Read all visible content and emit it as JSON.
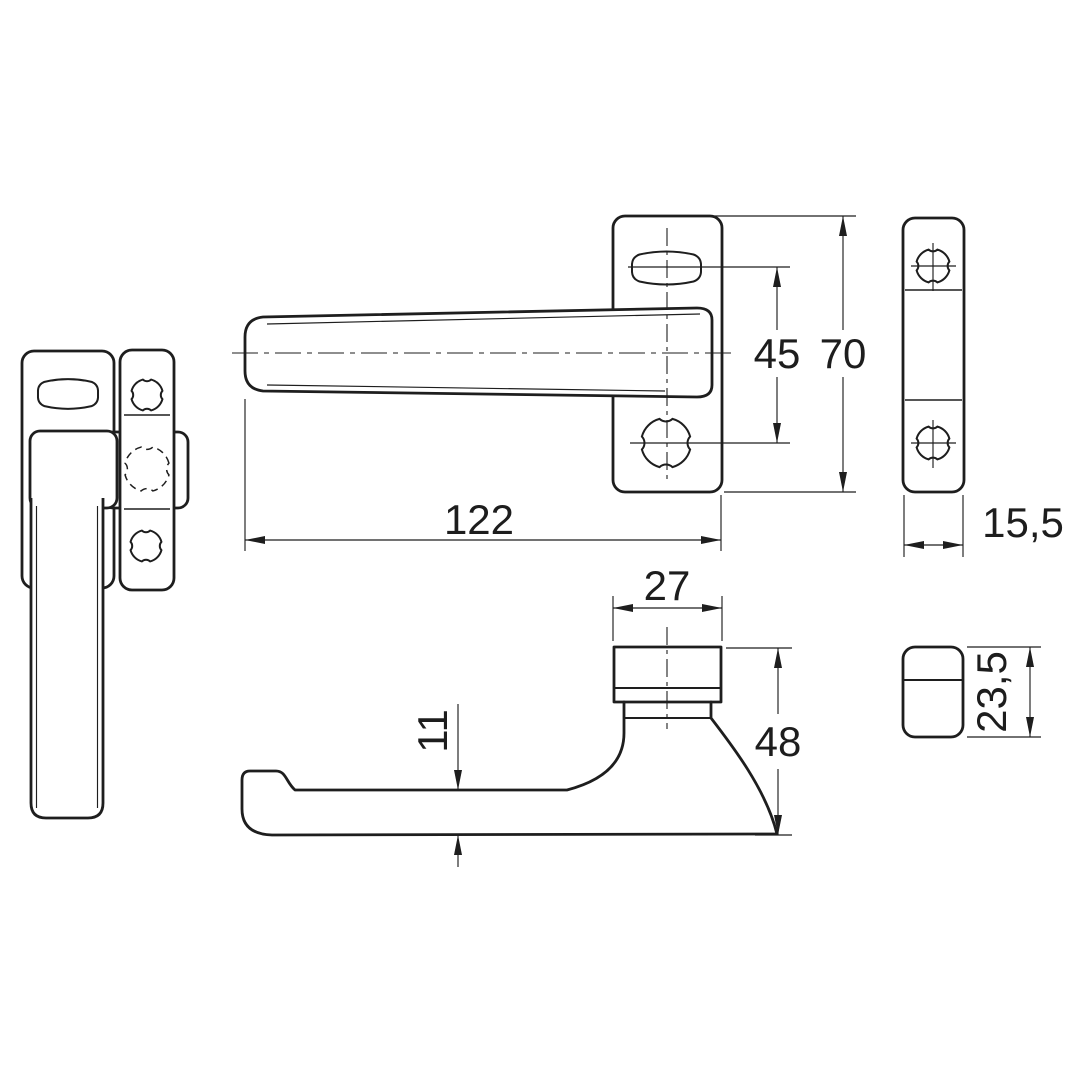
{
  "colors": {
    "line": "#1e1e1e",
    "text": "#1d1d1d",
    "background": "#ffffff"
  },
  "dims": {
    "lever_length": "122",
    "hole_spacing": "45",
    "plate_height": "70",
    "plate_width": "15,5",
    "hub_width": "27",
    "handle_projection": "48",
    "grip_thickness": "11",
    "hub_depth": "23,5"
  }
}
